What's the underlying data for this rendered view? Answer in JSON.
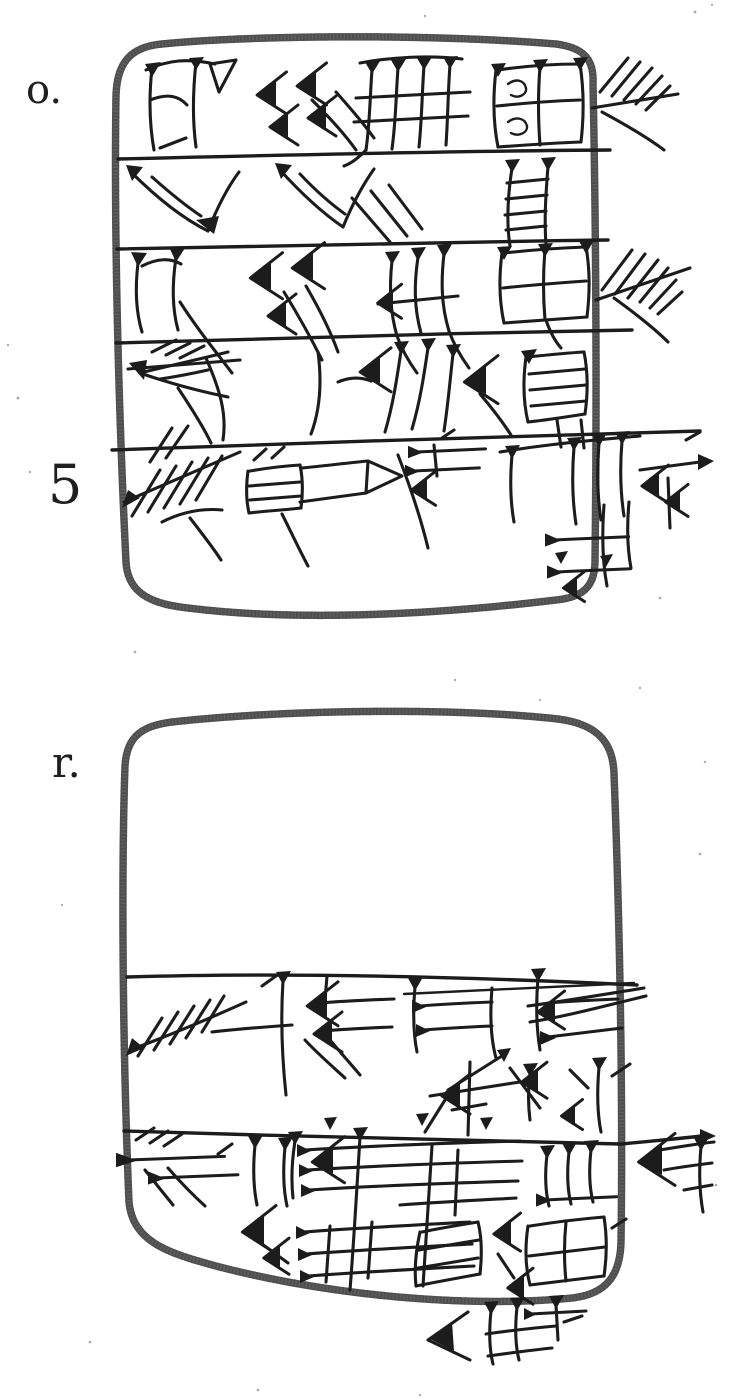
{
  "figure": {
    "labels": {
      "obverse": "o.",
      "line_five": "5",
      "reverse": "r."
    },
    "colors": {
      "ink": "#1c1c1c",
      "outline": "#4f4f4f",
      "paper": "#ffffff"
    }
  }
}
